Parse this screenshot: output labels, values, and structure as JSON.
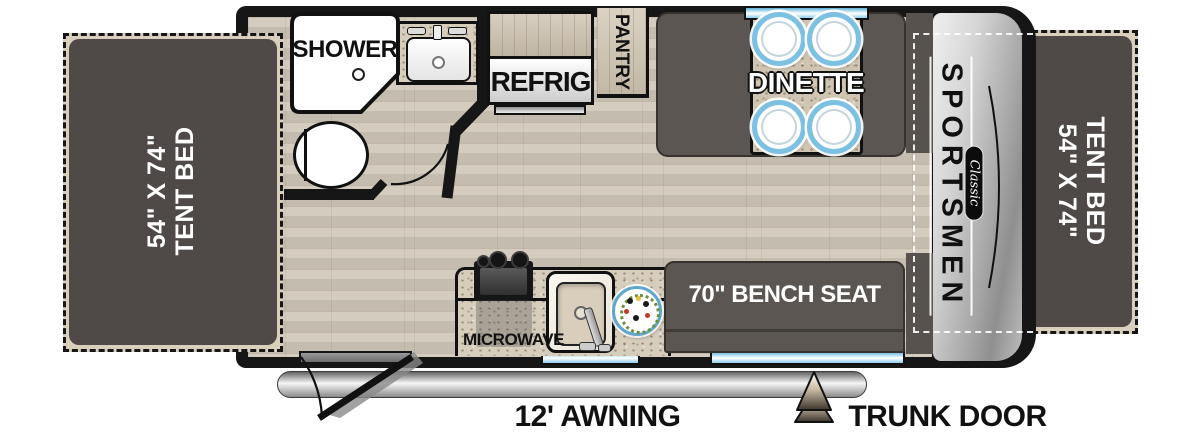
{
  "plan_title": "Travel trailer floor plan",
  "brand": {
    "name": "SPORTSMEN",
    "series": "Classic"
  },
  "beds": {
    "size": "54\" X 74\"",
    "name": "TENT BED"
  },
  "bathroom": {
    "shower": "SHOWER"
  },
  "kitchen": {
    "refrig": "REFRIG",
    "pantry": "PANTRY",
    "microwave": "MICROWAVE"
  },
  "dinette": {
    "label": "DINETTE"
  },
  "bench": {
    "label": "70\" BENCH SEAT"
  },
  "exterior": {
    "awning": "12' AWNING",
    "trunk_door": "TRUNK DOOR"
  },
  "colors": {
    "wall": "#161616",
    "floor_wood": "#cfc7b8",
    "counter_speckle": "#d6cdbd",
    "seat_dark": "#5b5651",
    "bed_fill": "#494542",
    "window_blue": "#7ec4e6",
    "plate_rim": "#7cc0e2",
    "cap_silver": "#c0c0c0",
    "awning_gray": "#bdbdbd"
  }
}
